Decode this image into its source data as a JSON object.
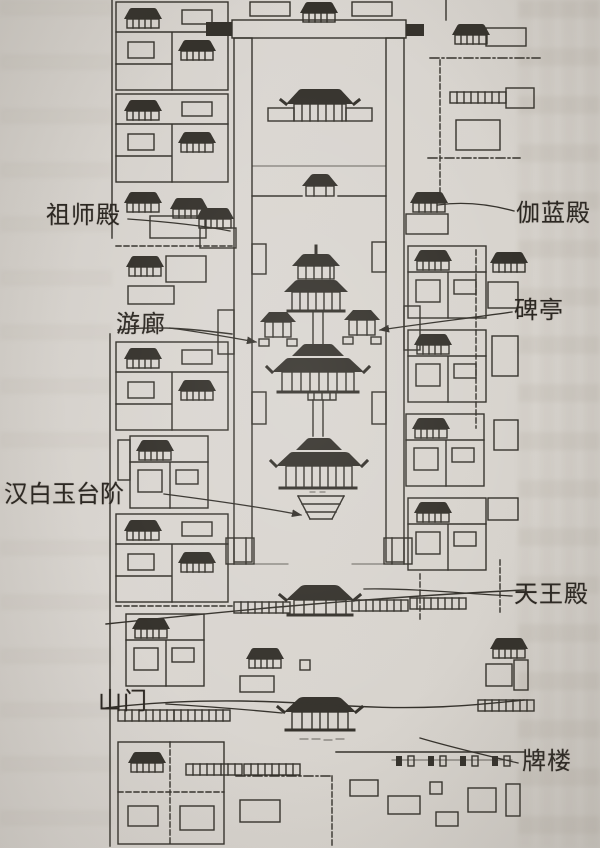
{
  "figure": {
    "labels": [
      {
        "id": "zushidian",
        "text": "祖师殿",
        "side": "left"
      },
      {
        "id": "qielandian",
        "text": "伽蓝殿",
        "side": "right"
      },
      {
        "id": "youlang",
        "text": "游廊",
        "side": "left"
      },
      {
        "id": "beiting",
        "text": "碑亭",
        "side": "right"
      },
      {
        "id": "hanbaiyu",
        "text": "汉白玉台阶",
        "side": "left"
      },
      {
        "id": "tianwangdian",
        "text": "天王殿",
        "side": "right"
      },
      {
        "id": "shanmen",
        "text": "山门",
        "side": "left"
      },
      {
        "id": "pailou",
        "text": "牌楼",
        "side": "right"
      }
    ],
    "colors": {
      "paper": "#d7d3cd",
      "ink": "#35322c",
      "label_text": "#2b2722"
    }
  }
}
